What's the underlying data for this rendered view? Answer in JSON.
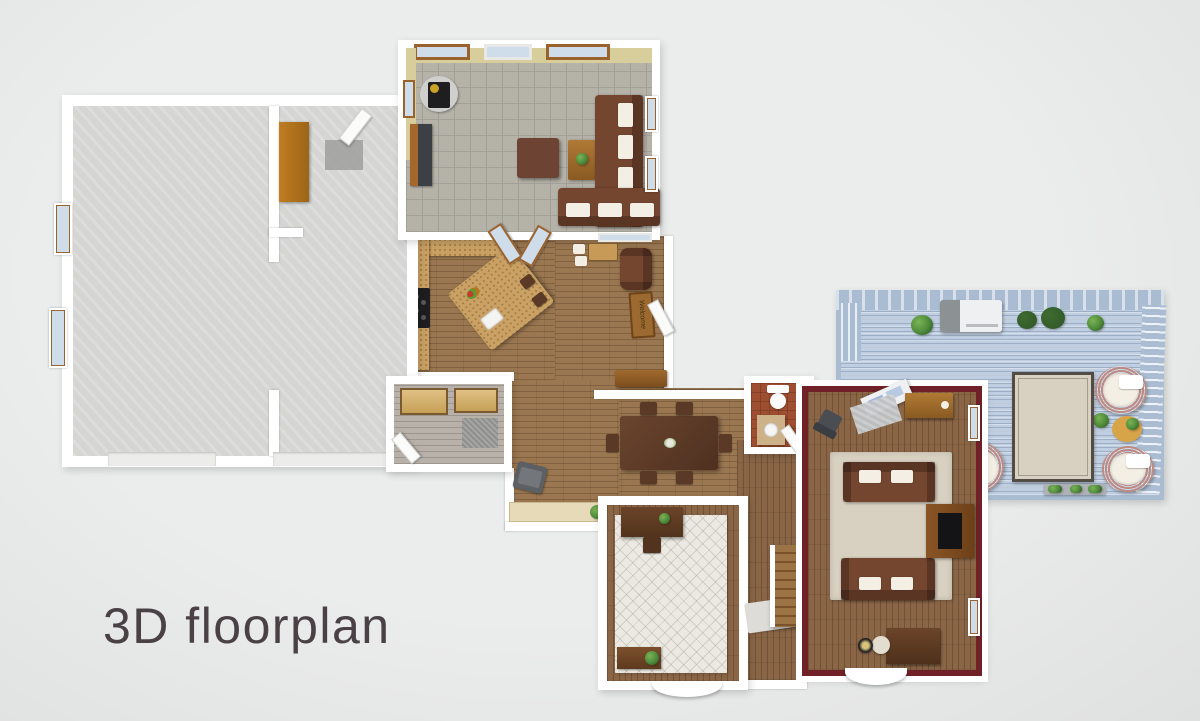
{
  "caption": {
    "text": "3D floorplan"
  },
  "labels": {
    "welcome_mat": "Welcome"
  },
  "colors": {
    "bg": "#ebecec",
    "bg_edge": "#dfe0e0",
    "wall": "#ffffff",
    "wall_tan": "#d8ce9b",
    "wall_maroon": "#6f2127",
    "concrete": "#d5d6d4",
    "tile": "#b5b2a8",
    "tile_line": "#a3a098",
    "wood": "#9a7751",
    "wood_dark": "#8a6647",
    "graywood": "#b7b1a9",
    "deck": "#bfcee0",
    "deck_rail": "#a9bcd2",
    "terracotta": "#9e4f31",
    "counter": "#c9a164",
    "leather": "#74452f",
    "sofa_dark": "#5e3c2c",
    "cushion": "#f3efe5",
    "rug_beige": "#d8d0c0",
    "rug_white": "#ebe9e2",
    "rug_border": "#514c44",
    "darktable": "#5a3a26",
    "cabinet": "#b5771f",
    "stove": "#1e1e20",
    "grill": "#eef0f1",
    "grill_gray": "#8c9194",
    "plant": "#4e8a3a",
    "plant_dark": "#2d5526",
    "wicker": "#bd8a84",
    "yellow_table": "#d8a448",
    "mat": "#9b9b99",
    "glass": "#cfdcea",
    "frame": "#9a632e",
    "caption": "#4a4146"
  }
}
